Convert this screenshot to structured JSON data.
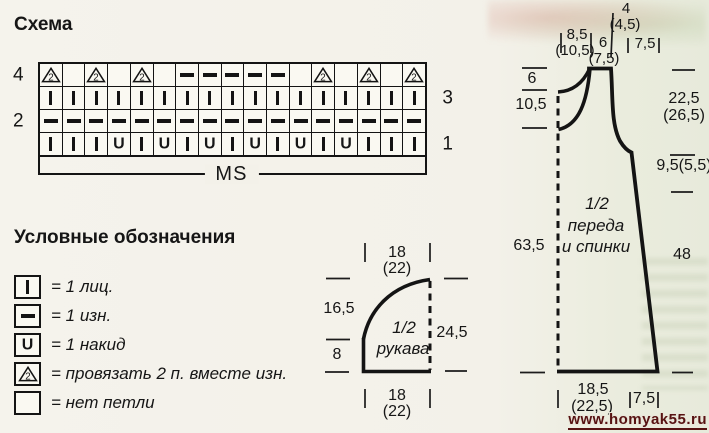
{
  "colors": {
    "ink": "#1a1a1a",
    "background": "#f2f1e8",
    "watermark": "#571212"
  },
  "chart": {
    "title": "Схема",
    "repeat_label": "MS",
    "rows": [
      {
        "row_number_left": "4",
        "row_number_right": "",
        "cells": [
          "k2tog",
          "",
          "k2tog",
          "",
          "k2tog",
          "",
          "p",
          "p",
          "p",
          "p",
          "p",
          "",
          "k2tog",
          "",
          "k2tog",
          "",
          "k2tog"
        ]
      },
      {
        "row_number_left": "",
        "row_number_right": "3",
        "cells": [
          "k",
          "k",
          "k",
          "k",
          "k",
          "k",
          "k",
          "k",
          "k",
          "k",
          "k",
          "k",
          "k",
          "k",
          "k",
          "k",
          "k"
        ]
      },
      {
        "row_number_left": "2",
        "row_number_right": "",
        "cells": [
          "p",
          "p",
          "p",
          "p",
          "p",
          "p",
          "p",
          "p",
          "p",
          "p",
          "p",
          "p",
          "p",
          "p",
          "p",
          "p",
          "p"
        ]
      },
      {
        "row_number_left": "",
        "row_number_right": "1",
        "cells": [
          "k",
          "k",
          "k",
          "yo",
          "k",
          "yo",
          "k",
          "yo",
          "k",
          "yo",
          "k",
          "yo",
          "k",
          "yo",
          "k",
          "k",
          "k"
        ]
      }
    ]
  },
  "legend": {
    "title": "Условные обозначения",
    "items": [
      {
        "symbol": "k",
        "text": "= 1 лиц."
      },
      {
        "symbol": "p",
        "text": "= 1 изн."
      },
      {
        "symbol": "yo",
        "text": "= 1 накид"
      },
      {
        "symbol": "k2tog",
        "text": "= провязать 2 п. вместе изн."
      },
      {
        "symbol": "none",
        "text": "= нет петли"
      }
    ]
  },
  "sleeve_piece": {
    "label": [
      "1/2",
      "рукава"
    ],
    "top_width": "18",
    "top_width_alt": "(22)",
    "bottom_width": "18",
    "bottom_width_alt": "(22)",
    "cap_height": "16,5",
    "cuff_height": "8",
    "center_length": "24,5"
  },
  "body_piece": {
    "label": [
      "1/2",
      "переда",
      "и спинки"
    ],
    "top": {
      "neck_half": "8,5",
      "neck_half_alt": "(10,5)",
      "strap": "6",
      "strap_alt": "(7,5)",
      "shoulder": "4",
      "shoulder_alt": "(4,5)",
      "armhole_inset": "7,5"
    },
    "left": {
      "back_neck_depth": "6",
      "front_neck_extra": "10,5",
      "length": "63,5"
    },
    "right": {
      "armhole_depth": "22,5",
      "armhole_depth_alt": "(26,5)",
      "underarm": "9,5(5,5)",
      "side_seam": "48"
    },
    "bottom": {
      "hem_half": "18,5",
      "hem_half_alt": "(22,5)",
      "flare": "7,5"
    }
  },
  "watermark": {
    "text": "www.homyak55.ru"
  }
}
